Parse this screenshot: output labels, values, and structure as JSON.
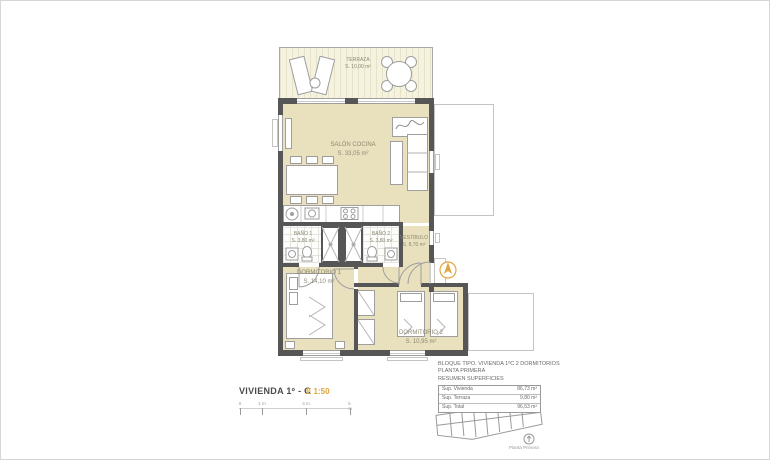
{
  "plan": {
    "rooms": {
      "terraza": {
        "name": "TERRAZA",
        "area": "S. 10,00 m²"
      },
      "salon": {
        "name": "SALÓN COCINA",
        "area": "S. 33,05 m²"
      },
      "bano1": {
        "name": "BAÑO 1",
        "area": "S. 3,80 m²"
      },
      "bano2": {
        "name": "BAÑO 2",
        "area": "S. 3,80 m²"
      },
      "vestibulo": {
        "name": "VESTÍBULO",
        "area": "S. 8,70 m²"
      },
      "dormitorio1": {
        "name": "DORMITORIO 1",
        "area": "S. 14,10 m²"
      },
      "dormitorio2": {
        "name": "DORMITORIO 2",
        "area": "S. 10,95 m²"
      }
    }
  },
  "footer": {
    "title": "VIVIENDA 1º - C",
    "scale": "E 1:50",
    "scalebar": {
      "ticks": [
        "0",
        "1 m",
        "3 m",
        "5 m"
      ]
    },
    "info": {
      "line1": "BLOQUE TIPO. VIVIENDA 1ºC 2 DORMITORIOS",
      "line2": "PLANTA PRIMERA",
      "line3": "RESUMEN SUPERFICIES"
    },
    "table": {
      "rows": [
        {
          "label": "Sup. Vivienda",
          "value": "86,73 m²"
        },
        {
          "label": "Sup. Terraza",
          "value": "9,80 m²"
        },
        {
          "label": "Sup. Total",
          "value": "96,53 m²"
        }
      ]
    },
    "keyplan_caption": "Planta Primera"
  },
  "colors": {
    "accent": "#e0a43c",
    "room_fill": "#e9e1bd",
    "wall": "#565656"
  }
}
